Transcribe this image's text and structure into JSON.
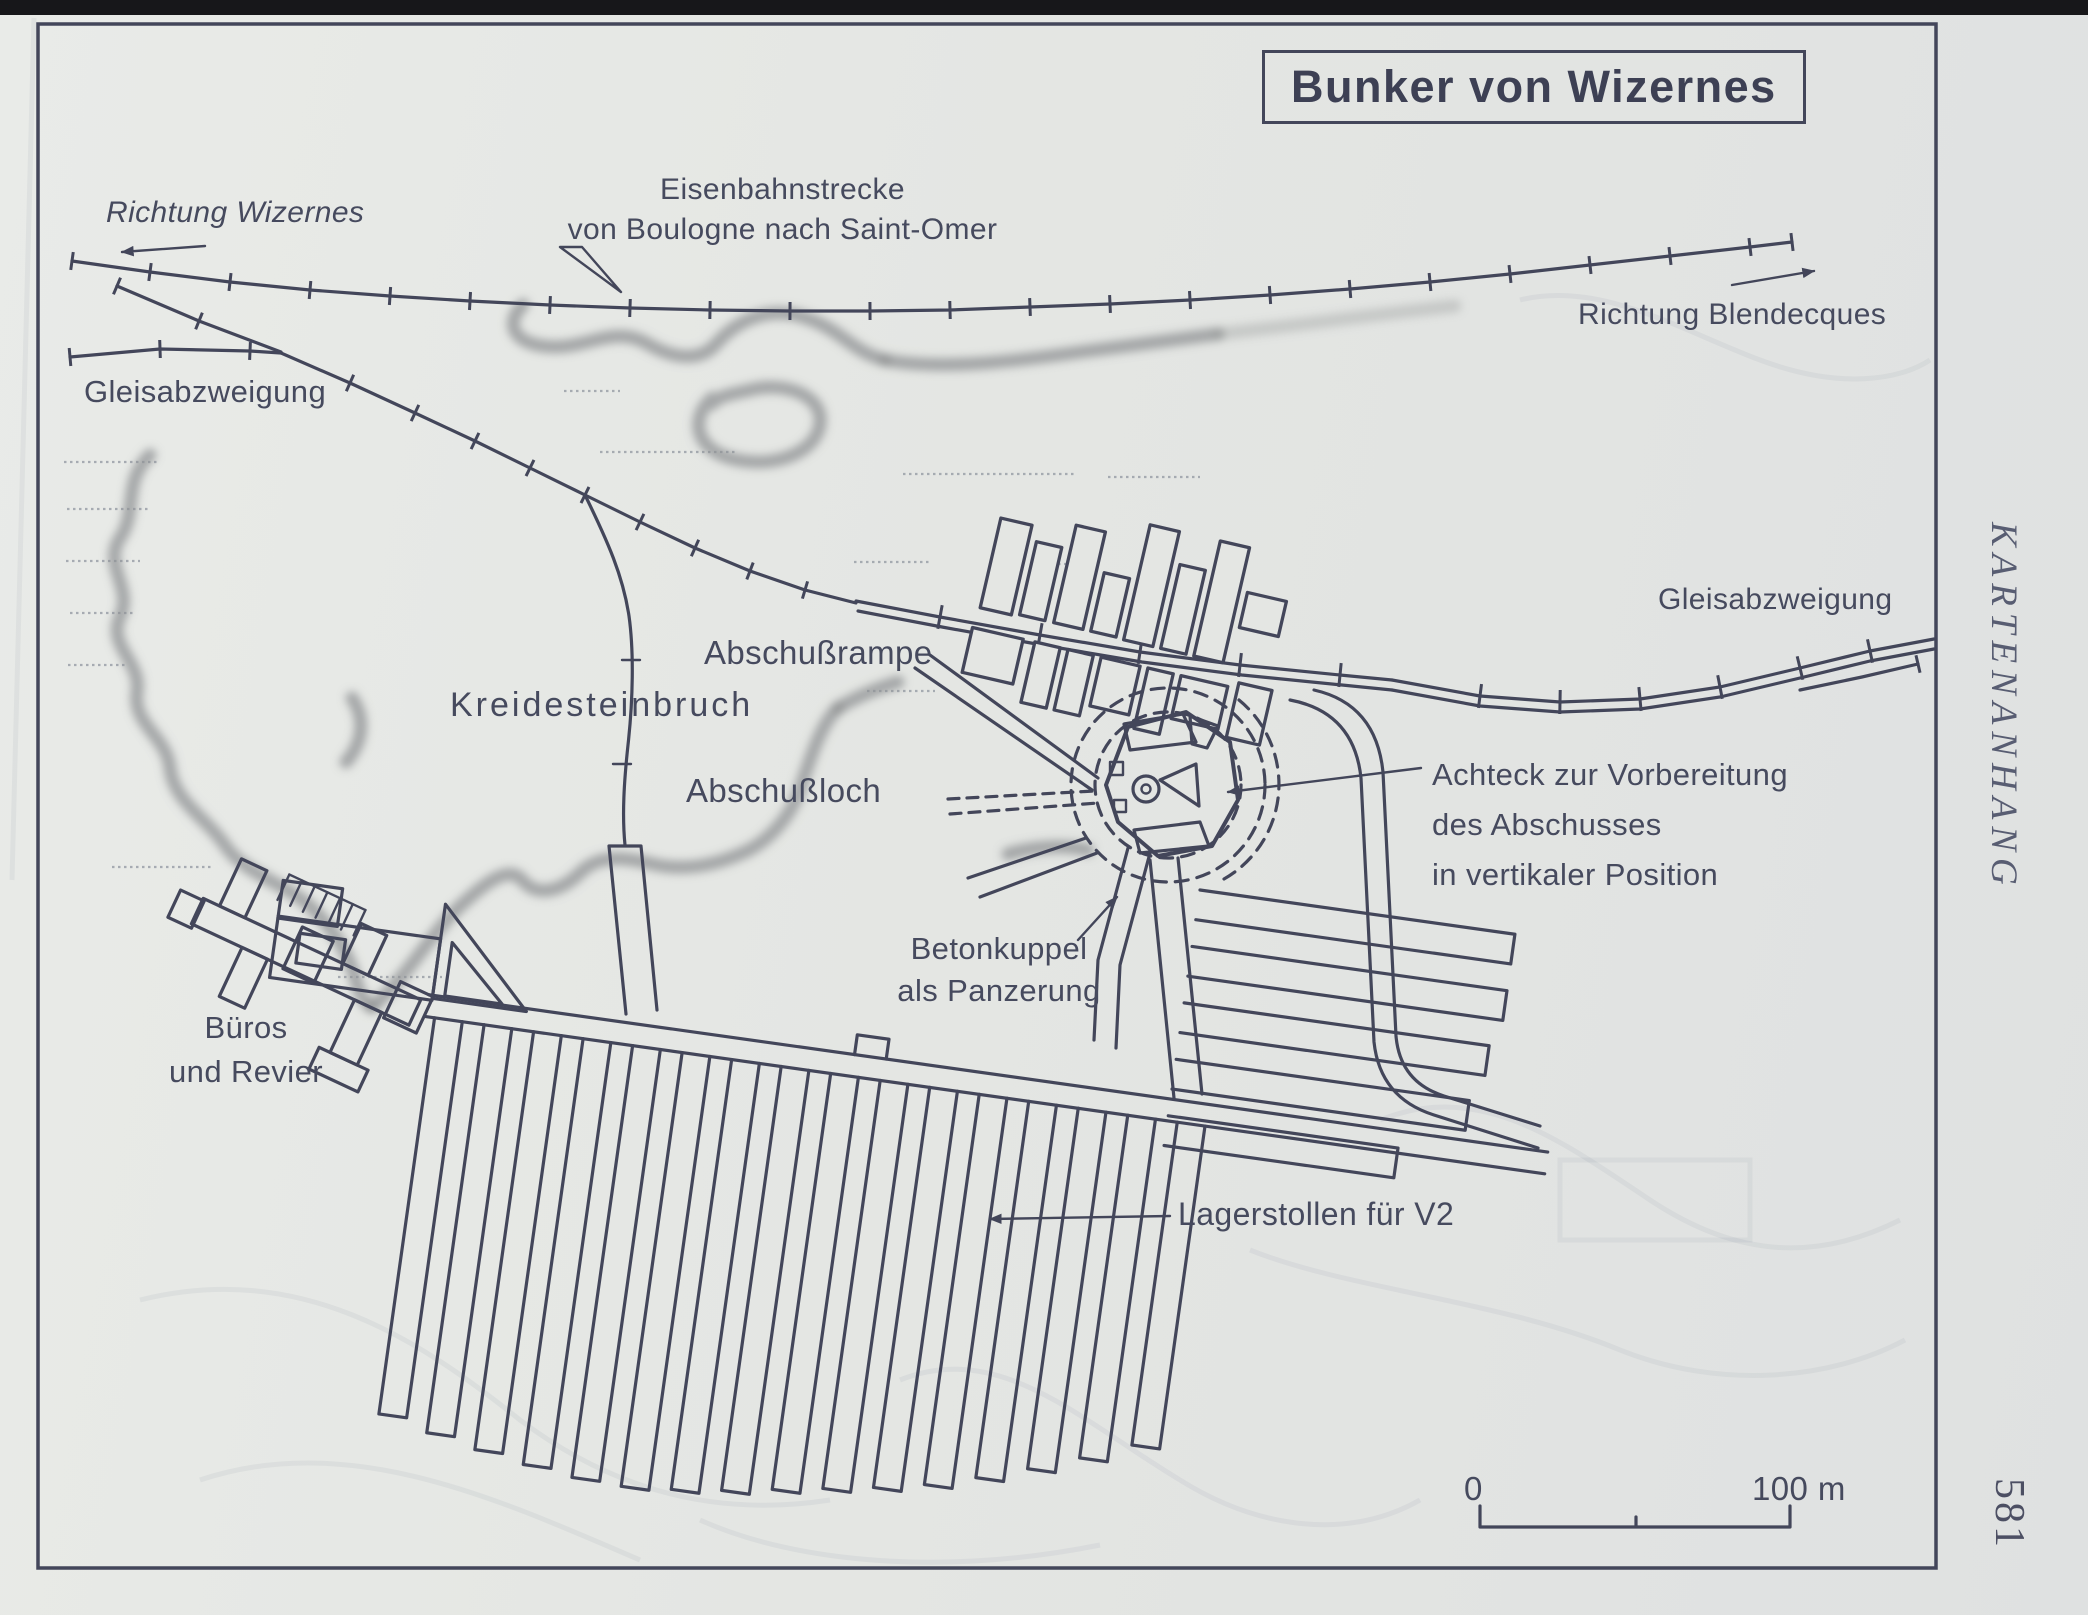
{
  "page": {
    "margin_heading": "KARTENANHANG",
    "page_number": "581"
  },
  "map": {
    "title": "Bunker von Wizernes",
    "labels": {
      "direction_west": "Richtung Wizernes",
      "railway_line_1": "Eisenbahnstrecke",
      "railway_line_2": "von Boulogne nach Saint-Omer",
      "direction_east": "Richtung Blendecques",
      "branch_left": "Gleisabzweigung",
      "branch_right": "Gleisabzweigung",
      "launch_ramp": "Abschußrampe",
      "chalk_quarry": "Kreidesteinbruch",
      "launch_hole": "Abschußloch",
      "octagon_1": "Achteck zur Vorbereitung",
      "octagon_2": "des Abschusses",
      "octagon_3": "in vertikaler Position",
      "dome_1": "Betonkuppel",
      "dome_2": "als Panzerung",
      "offices_1": "Büros",
      "offices_2": "und Revier",
      "storage": "Lagerstollen für V2"
    },
    "scale": {
      "start": "0",
      "end": "100 m"
    }
  },
  "colors": {
    "ink": "#43465a",
    "paper": "#e4e6e3",
    "text": "#464a5e",
    "fuzz": "#8f9193",
    "faint": "#9aa0a8",
    "edge": "#17171a"
  }
}
